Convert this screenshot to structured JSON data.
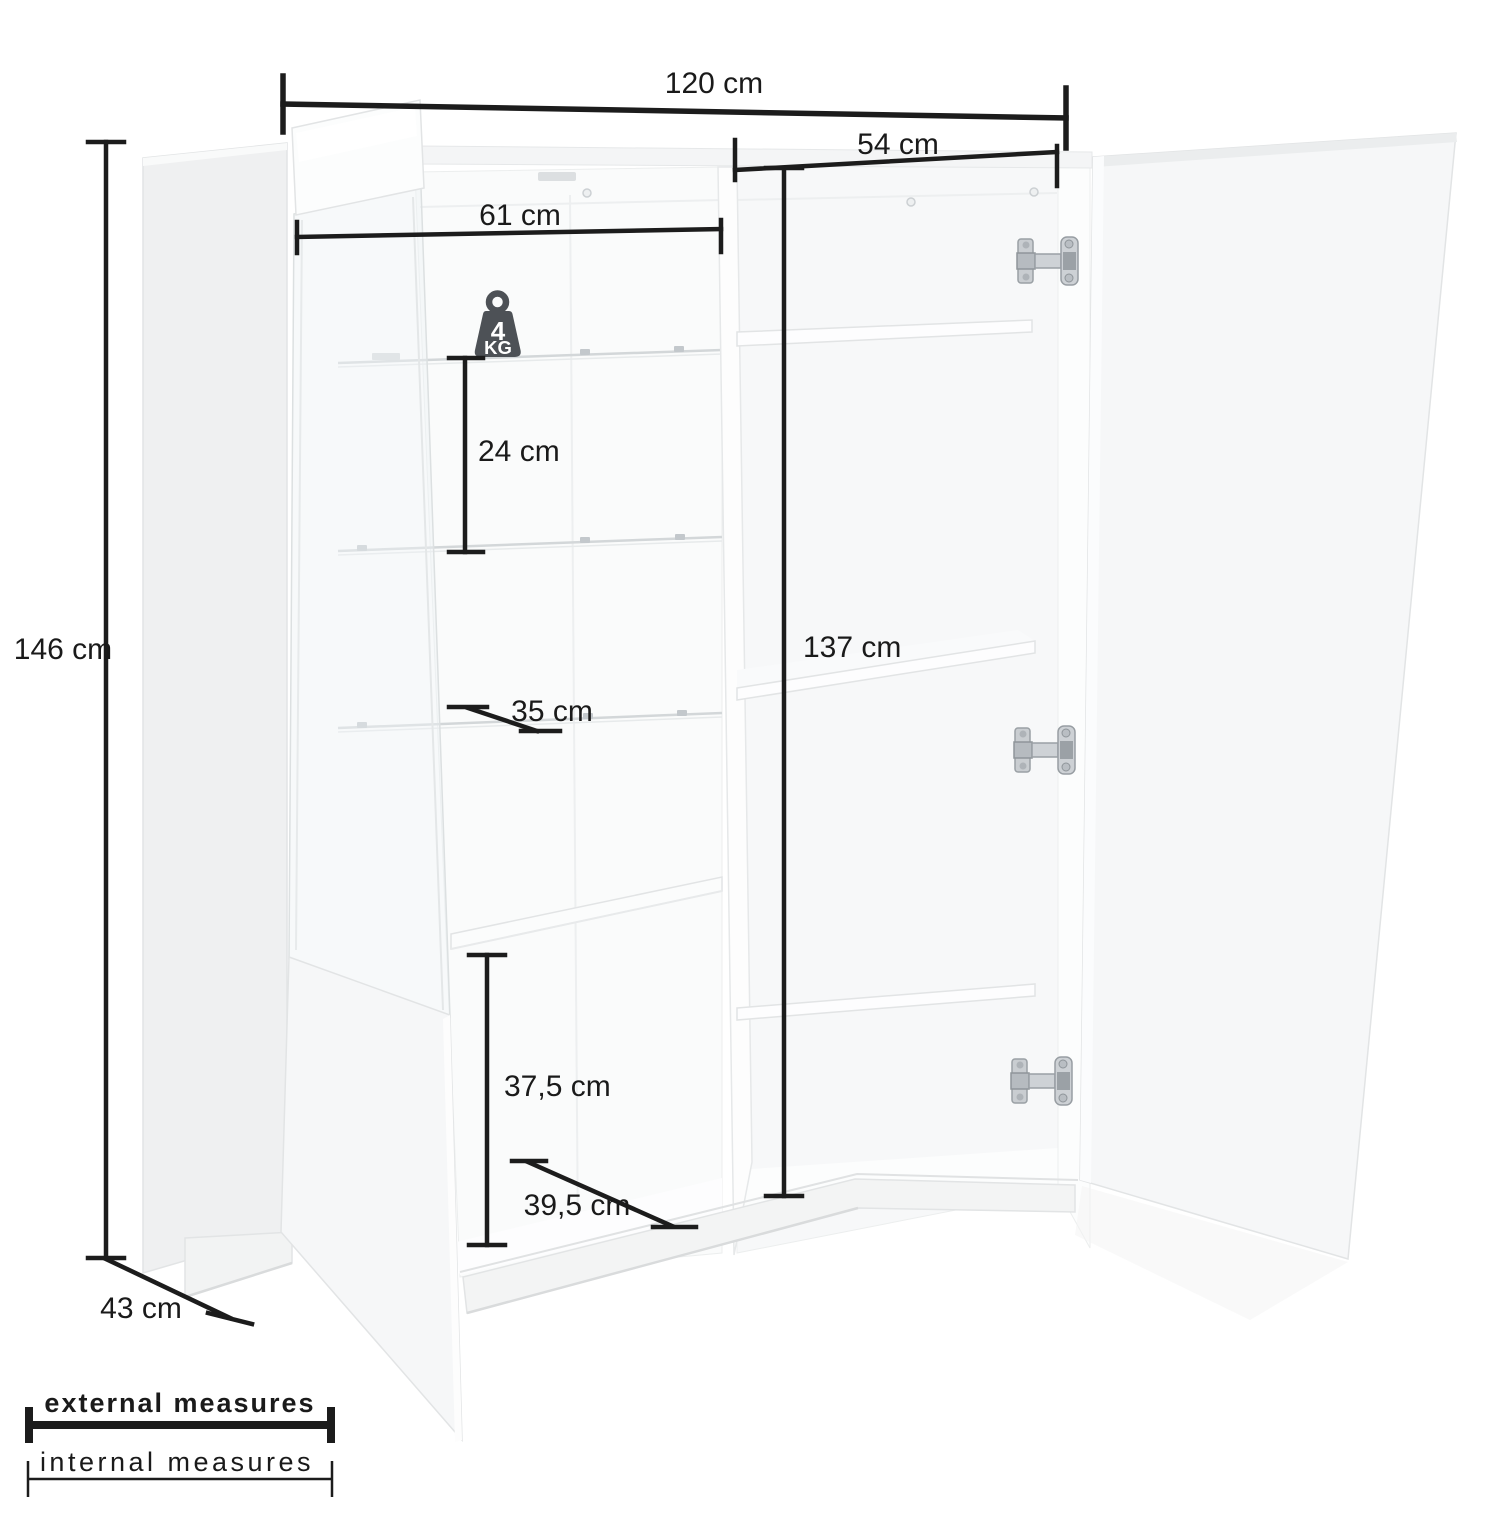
{
  "diagram_title": "cabinet-dimension-diagram",
  "measurements": {
    "width": "120 cm",
    "height": "146 cm",
    "depth": "43 cm",
    "left_inner_width": "61 cm",
    "right_inner_width": "54 cm",
    "glass_shelf_spacing": "24 cm",
    "glass_shelf_depth": "35 cm",
    "right_inner_height": "137 cm",
    "bottom_inner_height": "37,5 cm",
    "bottom_inner_width": "39,5 cm"
  },
  "weight_capacity": {
    "number": "4",
    "unit": "KG"
  },
  "legend": {
    "external_label": "external measures",
    "internal_label": "internal measures"
  },
  "colors": {
    "dimension_line": "#1c1c1c",
    "badge": "#4d5156",
    "panel_light": "#f6f7f8",
    "hinge_metal": "#c9cdd1"
  }
}
